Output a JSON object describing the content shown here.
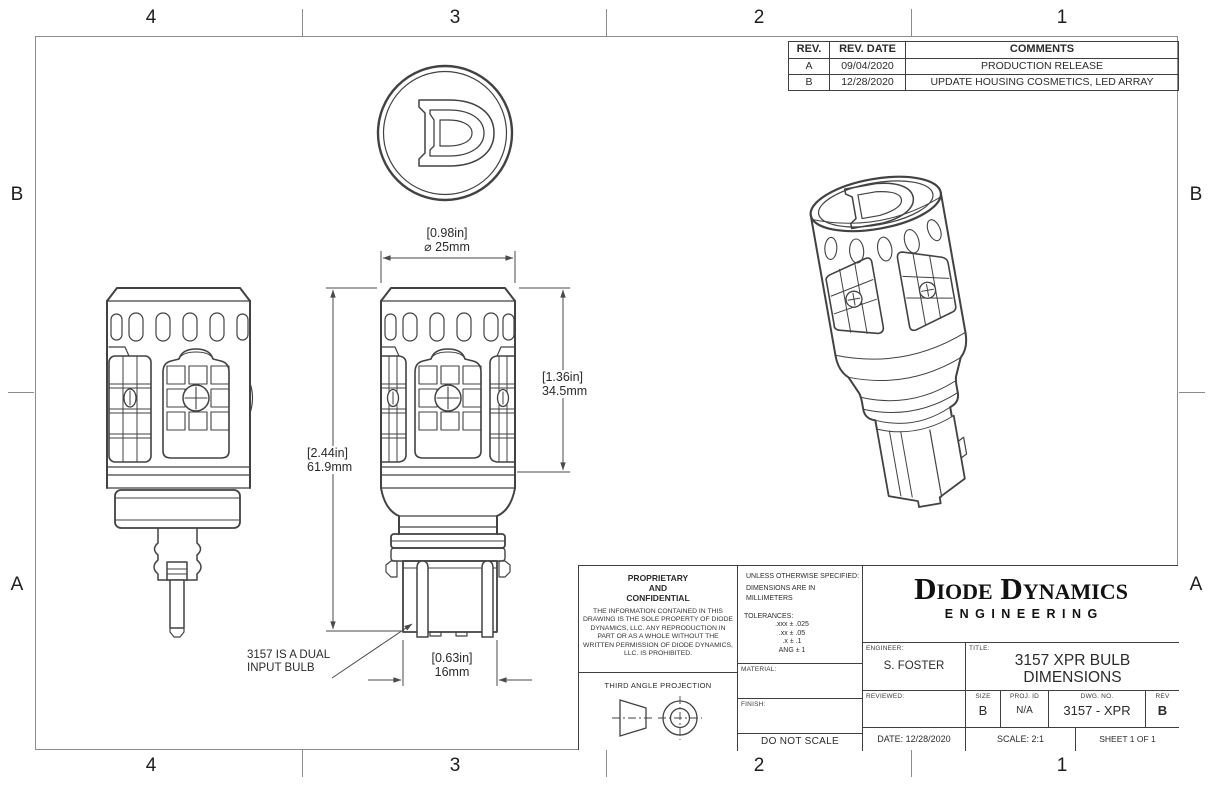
{
  "zone_labels": {
    "top": [
      "4",
      "3",
      "2",
      "1"
    ],
    "bottom": [
      "4",
      "3",
      "2",
      "1"
    ],
    "left_top": "B",
    "left_bottom": "A",
    "right_top": "B",
    "right_bottom": "A"
  },
  "revision_table": {
    "headers": {
      "rev": "REV.",
      "date": "REV. DATE",
      "comments": "COMMENTS"
    },
    "rows": [
      {
        "rev": "A",
        "date": "09/04/2020",
        "comments": "PRODUCTION RELEASE"
      },
      {
        "rev": "B",
        "date": "12/28/2020",
        "comments": "UPDATE HOUSING COSMETICS, LED ARRAY"
      }
    ]
  },
  "dimensions": {
    "diameter_in": "[0.98in]",
    "diameter_mm": "⌀ 25mm",
    "overall_height_in": "[2.44in]",
    "overall_height_mm": "61.9mm",
    "housing_height_in": "[1.36in]",
    "housing_height_mm": "34.5mm",
    "base_width_in": "[0.63in]",
    "base_width_mm": "16mm"
  },
  "note_text": "3157 IS A DUAL\nINPUT BULB",
  "title_block": {
    "proprietary_heading": "PROPRIETARY\nAND\nCONFIDENTIAL",
    "proprietary_body": "THE INFORMATION CONTAINED IN THIS DRAWING IS THE SOLE PROPERTY OF DIODE DYNAMICS, LLC.  ANY REPRODUCTION IN PART OR AS A WHOLE WITHOUT THE WRITTEN PERMISSION OF DIODE DYNAMICS, LLC. IS PROHIBITED.",
    "projection_label": "THIRD ANGLE PROJECTION",
    "specs_line1": "UNLESS OTHERWISE SPECIFIED:",
    "specs_line2": "DIMENSIONS ARE IN MILLIMETERS",
    "tolerances_heading": "TOLERANCES:",
    "tolerances": [
      ".xxx ±  .025",
      ".xx ±  .05",
      ".x ±  .1",
      "ANG ±  1"
    ],
    "material_label": "MATERIAL:",
    "finish_label": "FINISH:",
    "do_not_scale": "DO NOT SCALE DRAWING",
    "company_name": "Diode Dynamics",
    "company_division": "ENGINEERING",
    "engineer_label": "ENGINEER:",
    "engineer_value": "S. FOSTER",
    "reviewed_label": "REVIEWED:",
    "title_label": "TITLE:",
    "title_value": "3157 XPR BULB\nDIMENSIONS",
    "size_label": "SIZE",
    "size_value": "B",
    "proj_id_label": "PROJ. ID",
    "proj_id_value": "N/A",
    "dwg_no_label": "DWG.  NO.",
    "dwg_no_value": "3157 - XPR",
    "rev_label": "REV",
    "rev_value": "B",
    "date": "DATE: 12/28/2020",
    "scale": "SCALE: 2:1",
    "sheet": "SHEET 1 OF 1"
  },
  "colors": {
    "line_work": "#424242",
    "border_frame": "#8c8c8c",
    "table_border": "#3f3f3f",
    "text": "#2b2b2b",
    "background": "#ffffff"
  }
}
